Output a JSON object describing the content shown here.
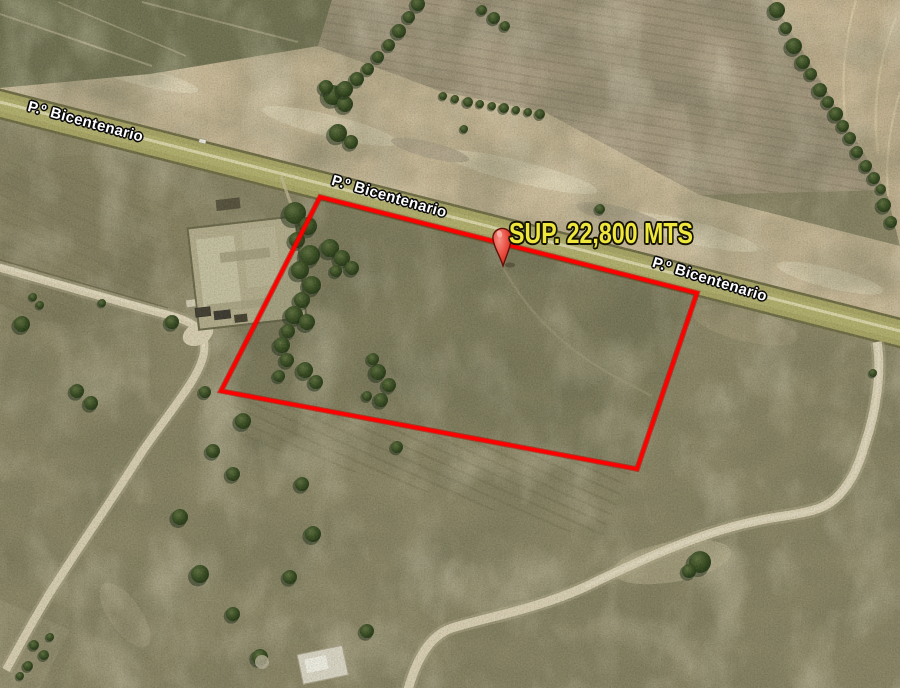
{
  "view": {
    "type": "satellite-imagery",
    "road_name": "P.º Bicentenario",
    "road_label_color": "#ffffff",
    "road_labels": [
      {
        "text": "P.º Bicentenario"
      },
      {
        "text": "P.º Bicentenario"
      },
      {
        "text": "P.º Bicentenario"
      }
    ],
    "parcel": {
      "surface_label": "SUP. 22,800 MTS",
      "outline_color": "#ff0000",
      "label_color": "#efe73b"
    },
    "placemark": {
      "icon": "red-pushpin-icon",
      "color": "#e2392c"
    }
  }
}
